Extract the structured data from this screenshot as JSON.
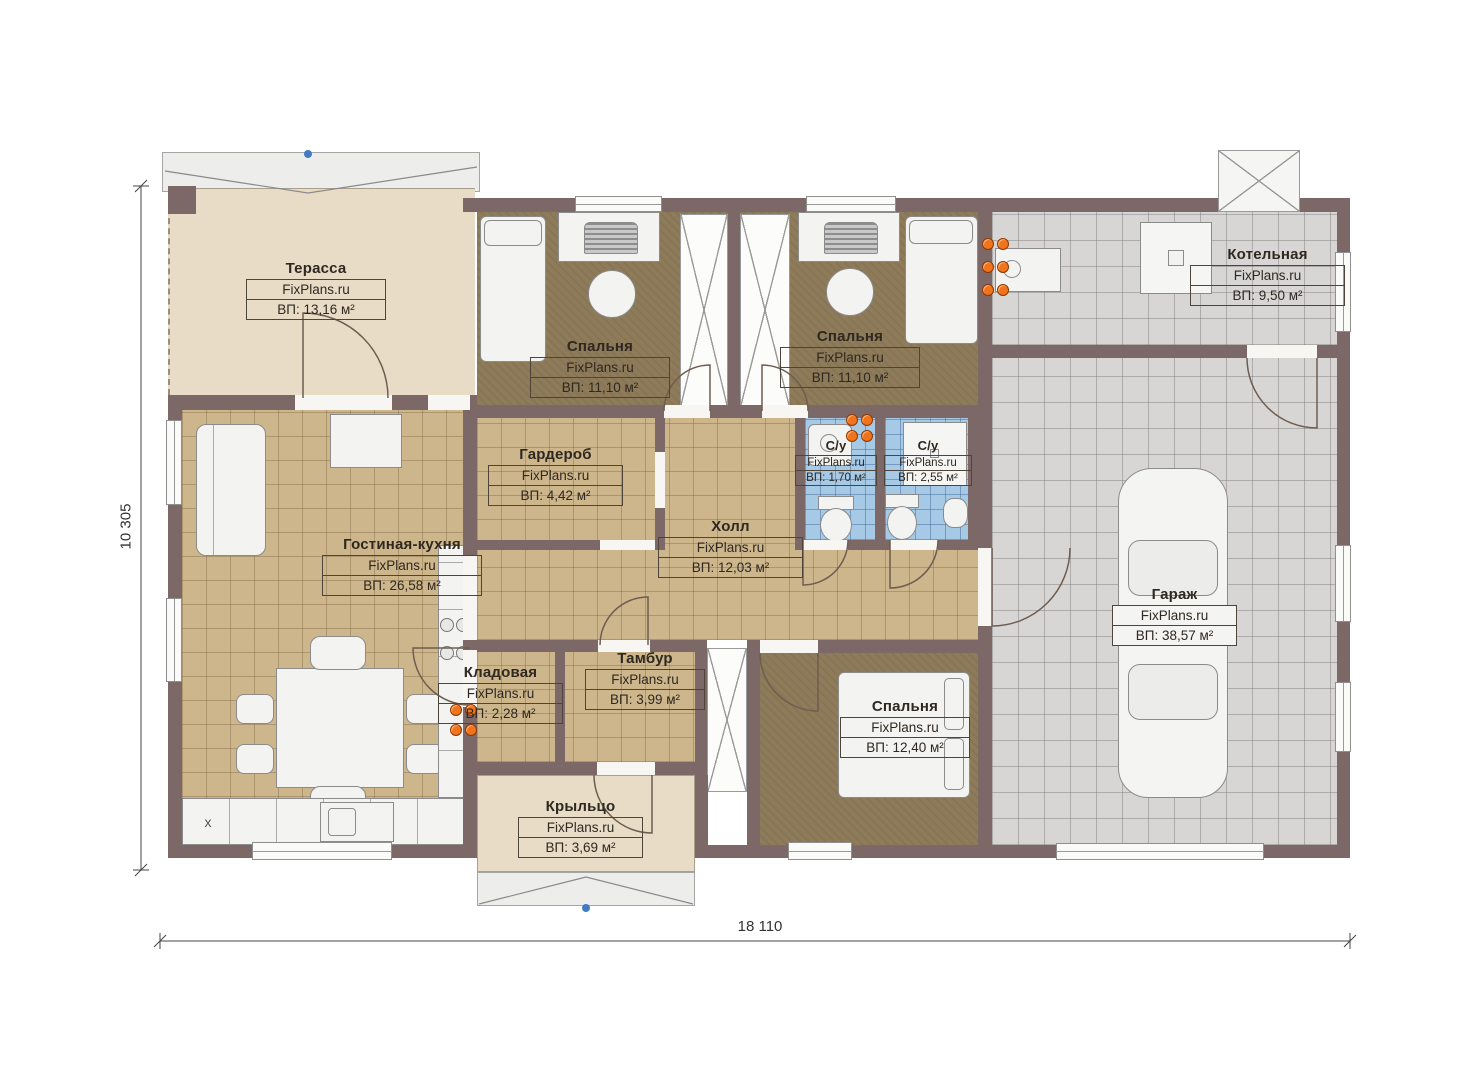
{
  "watermark": "FixPlans.ru",
  "dimensions": {
    "bottom": "18 110",
    "left": "10 305"
  },
  "kitchen": {
    "cabinet_mark": "x"
  },
  "rooms": [
    {
      "id": "terrace",
      "name": "Терасса",
      "area": "ВП: 13,16 м²"
    },
    {
      "id": "bedroom-top-left",
      "name": "Спальня",
      "area": "ВП: 11,10 м²"
    },
    {
      "id": "bedroom-top-right",
      "name": "Спальня",
      "area": "ВП: 11,10 м²"
    },
    {
      "id": "boiler-room",
      "name": "Котельная",
      "area": "ВП: 9,50 м²"
    },
    {
      "id": "wardrobe",
      "name": "Гардероб",
      "area": "ВП: 4,42 м²"
    },
    {
      "id": "hall",
      "name": "Холл",
      "area": "ВП: 12,03 м²"
    },
    {
      "id": "bathroom-small",
      "name": "С/у",
      "area": "ВП: 1,70 м²"
    },
    {
      "id": "bathroom-large",
      "name": "С/у",
      "area": "ВП: 2,55 м²"
    },
    {
      "id": "living-kitchen",
      "name": "Гостиная-кухня",
      "area": "ВП: 26,58 м²"
    },
    {
      "id": "pantry",
      "name": "Кладовая",
      "area": "ВП: 2,28 м²"
    },
    {
      "id": "vestibule",
      "name": "Тамбур",
      "area": "ВП: 3,99 м²"
    },
    {
      "id": "garage",
      "name": "Гараж",
      "area": "ВП: 38,57 м²"
    },
    {
      "id": "bedroom-bottom",
      "name": "Спальня",
      "area": "ВП: 12,40 м²"
    },
    {
      "id": "porch",
      "name": "Крыльцо",
      "area": "ВП: 3,69 м²"
    }
  ],
  "colors": {
    "wall": "#7d6868",
    "terrace_floor": "#e9dcc7",
    "tile_tan": "#cdb68c",
    "carpet_brown": "#8e7b5a",
    "tile_blue": "#a6c9e6",
    "tile_gray": "#d7d6d4",
    "radiator_orange": "#f0741c",
    "marker_blue": "#3f7cc4"
  }
}
